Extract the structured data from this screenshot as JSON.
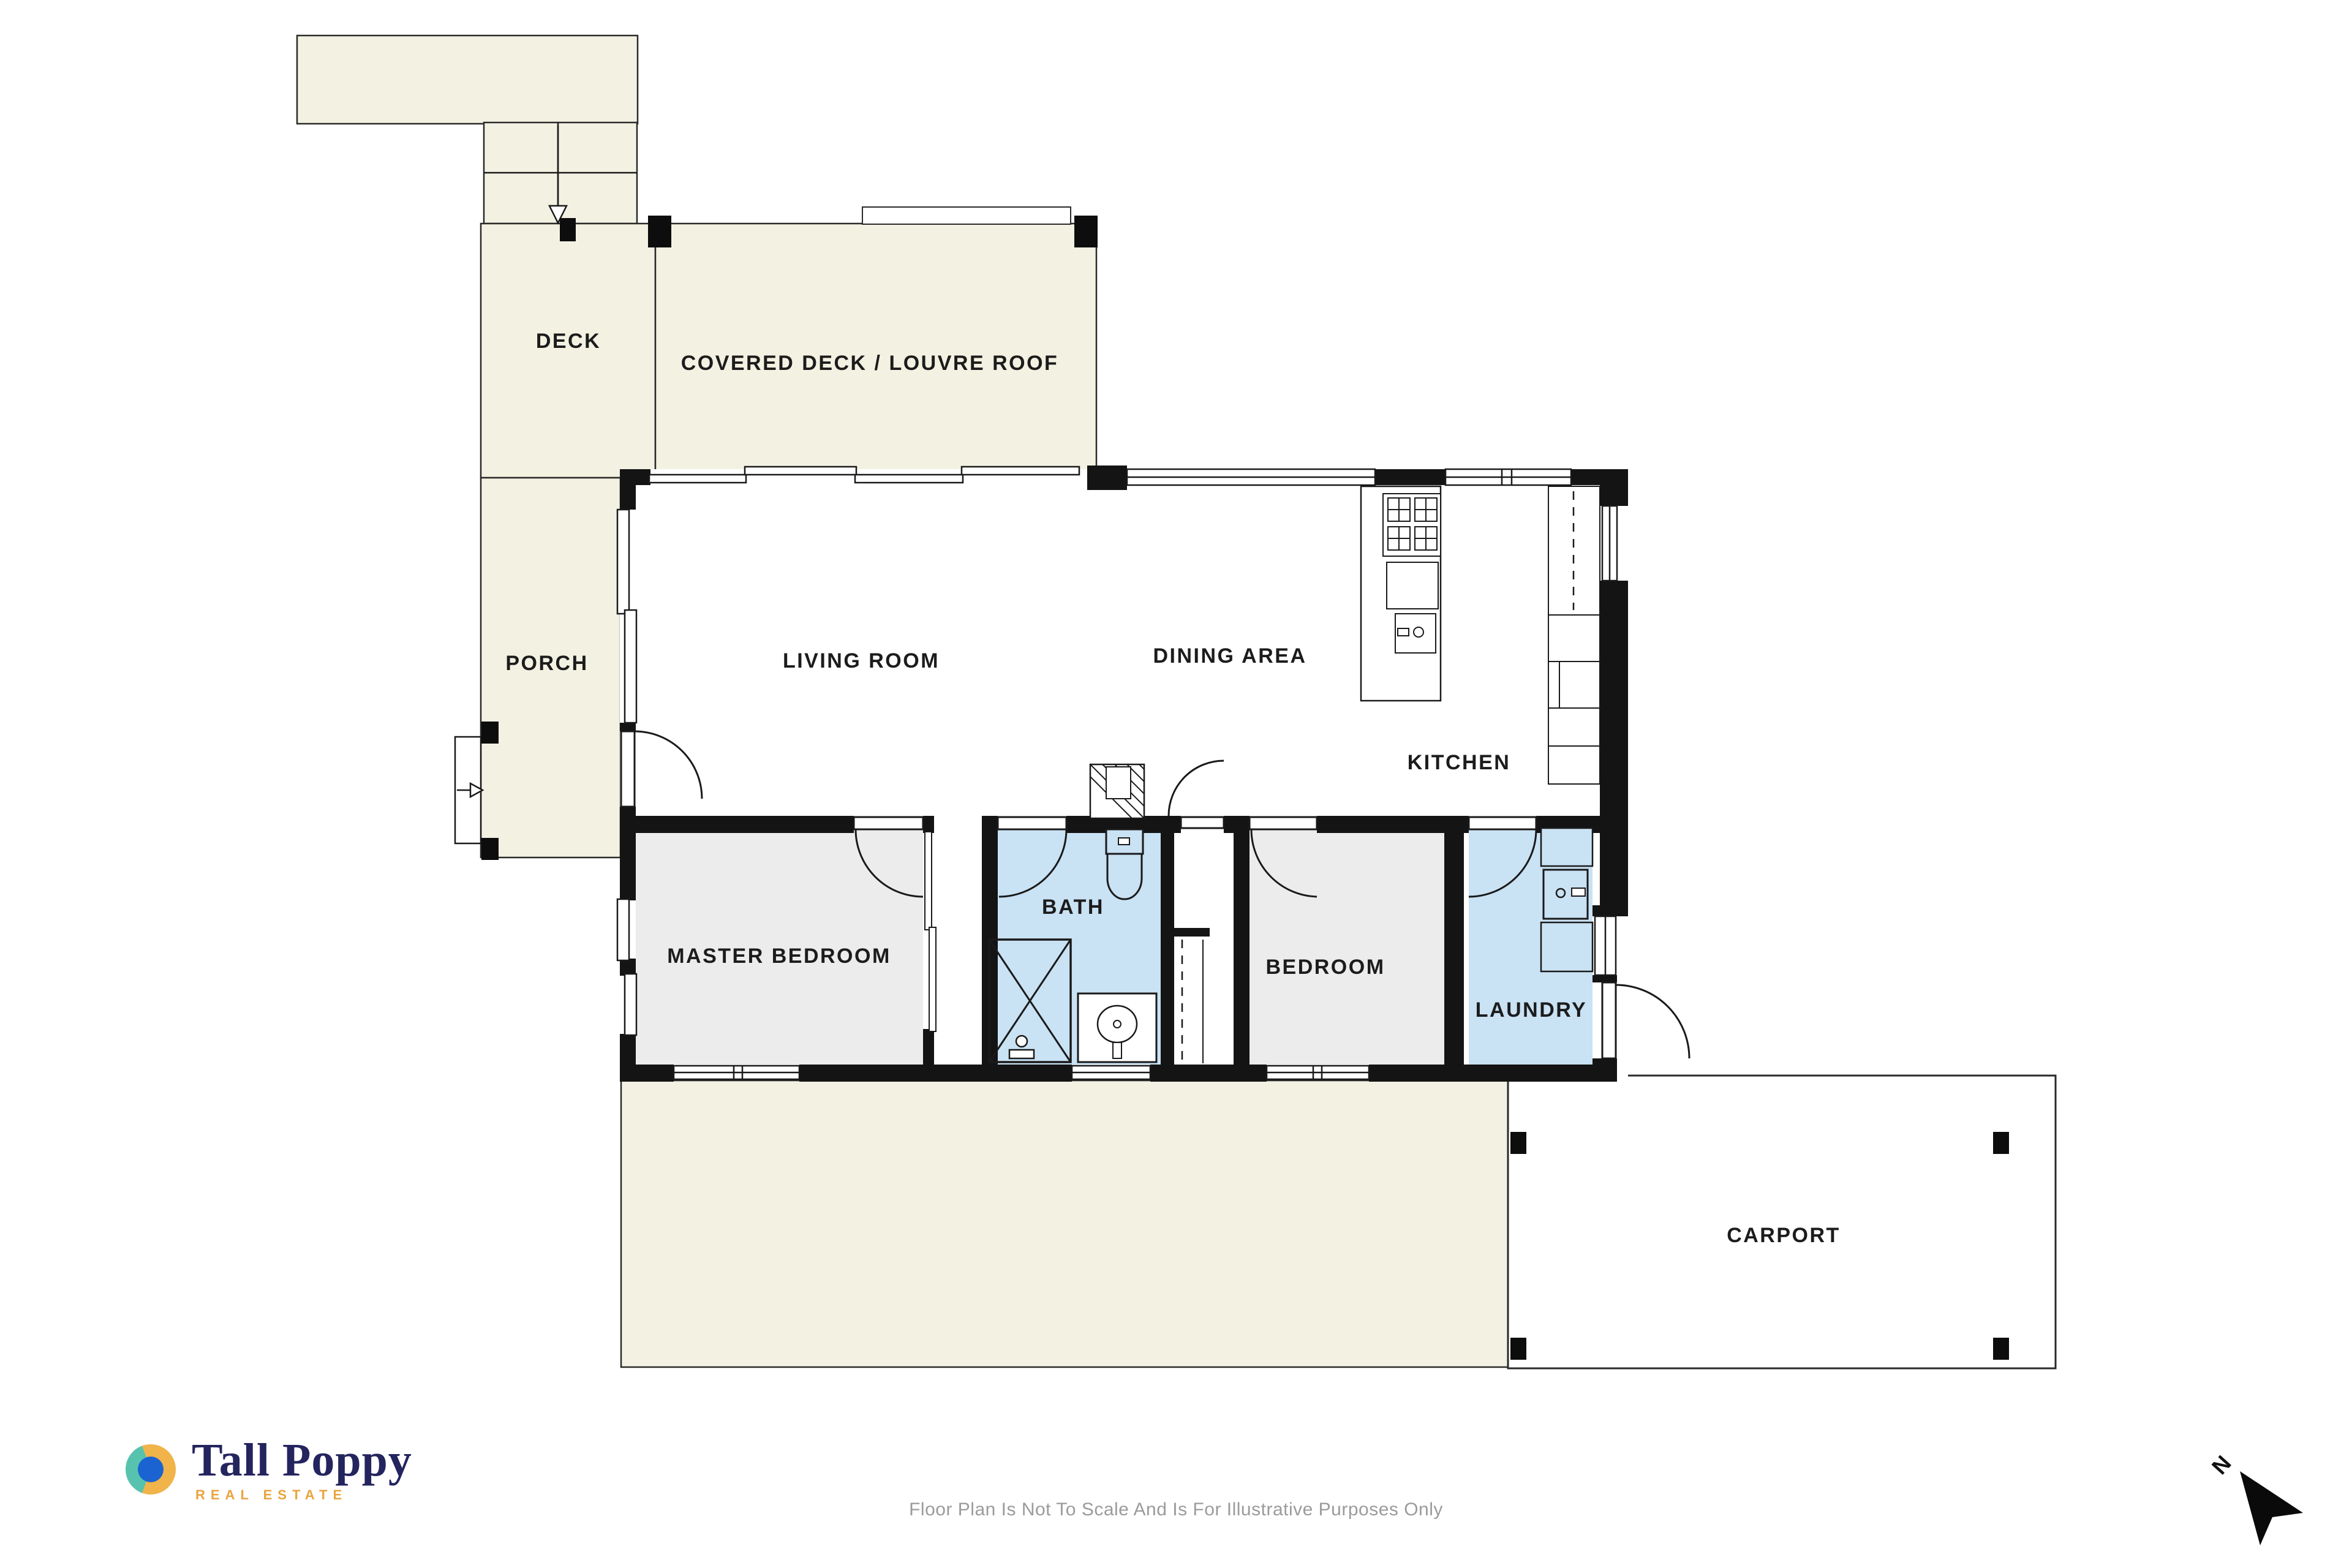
{
  "rooms": [
    {
      "id": "deck",
      "label": "DECK"
    },
    {
      "id": "covered-deck",
      "label": "COVERED DECK / LOUVRE ROOF"
    },
    {
      "id": "porch",
      "label": "PORCH"
    },
    {
      "id": "living-room",
      "label": "LIVING ROOM"
    },
    {
      "id": "dining-area",
      "label": "DINING AREA"
    },
    {
      "id": "kitchen",
      "label": "KITCHEN"
    },
    {
      "id": "master-bedroom",
      "label": "MASTER BEDROOM"
    },
    {
      "id": "bath",
      "label": "BATH"
    },
    {
      "id": "bedroom",
      "label": "BEDROOM"
    },
    {
      "id": "laundry",
      "label": "LAUNDRY"
    },
    {
      "id": "carport",
      "label": "CARPORT"
    }
  ],
  "branding": {
    "brand_name": "Tall Poppy",
    "tagline": "REAL ESTATE"
  },
  "footer": {
    "disclaimer": "Floor Plan Is Not To Scale And Is For Illustrative Purposes Only"
  },
  "compass": {
    "north_label": "N"
  },
  "colors": {
    "outdoor_area": "#f3f2e2",
    "wet_room_fill": "#c9e2f4",
    "bedroom_fill": "#ececec",
    "wall": "#141414",
    "carport_fill": "#ffffff",
    "line": "#1a1a1a",
    "label_text": "#1c1c1c",
    "disclaimer_text": "#9b9b9b",
    "brand_navy": "#24245e",
    "brand_gold": "#e9a43e",
    "brand_teal": "#57c3ae",
    "brand_blue": "#1b63d1"
  }
}
